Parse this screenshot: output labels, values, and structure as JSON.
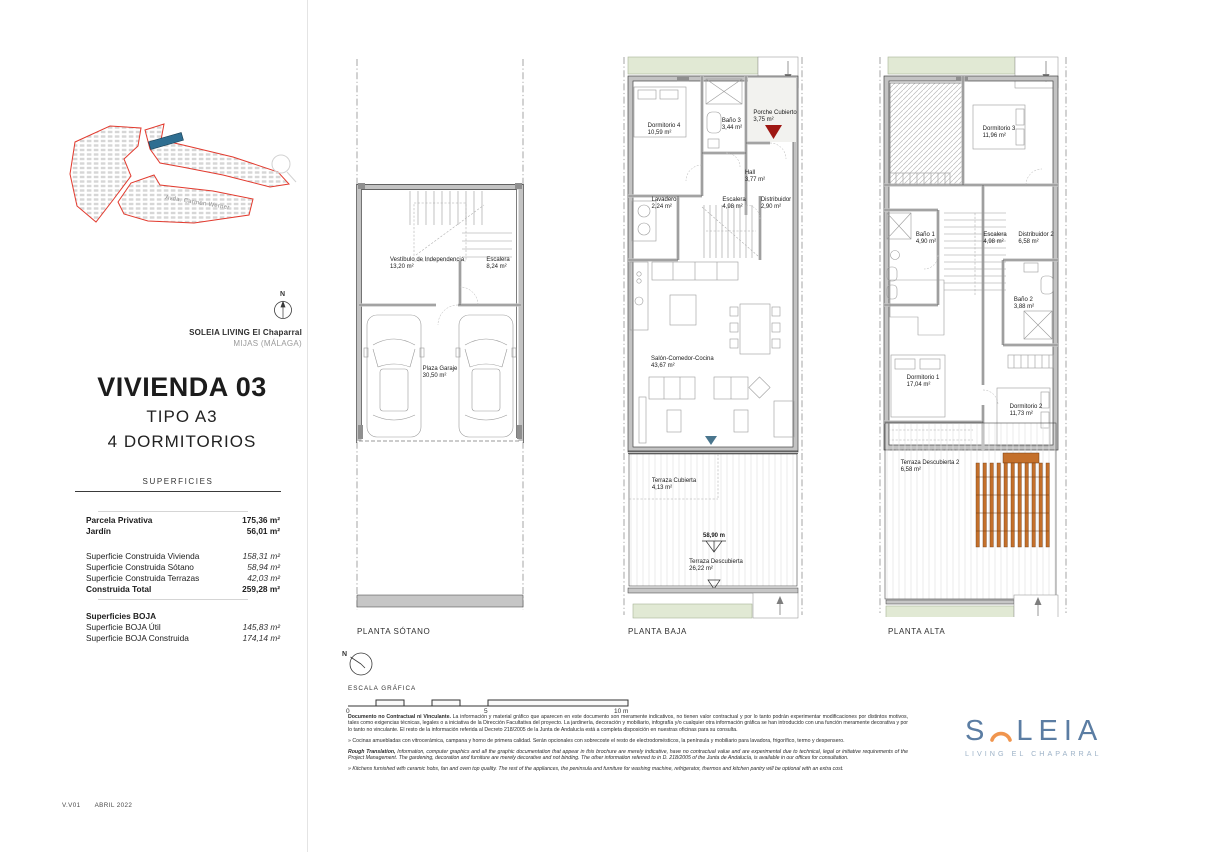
{
  "meta": {
    "version": "V.V01",
    "date": "ABRIL 2022"
  },
  "site": {
    "project_name": "SOLEIA LIVING El Chaparral",
    "location": "MIJAS (MÁLAGA)",
    "street": "Avda. Carmen Werner",
    "north_label": "N"
  },
  "title": {
    "vivienda": "VIVIENDA 03",
    "tipo": "TIPO A3",
    "dormitorios": "4 DORMITORIOS"
  },
  "superficies": {
    "header": "SUPERFICIES",
    "rows": [
      {
        "label": "Parcela Privativa",
        "value": "175,36 m²"
      },
      {
        "label": "Jardín",
        "value": "56,01 m²"
      },
      {
        "label": "Superficie Construida Vivienda",
        "value": "158,31 m²"
      },
      {
        "label": "Superficie Construida Sótano",
        "value": "58,94 m²"
      },
      {
        "label": "Superficie Construida Terrazas",
        "value": "42,03 m²"
      },
      {
        "label": "Construida Total",
        "value": "259,28 m²"
      },
      {
        "label": "Superficies BOJA",
        "value": ""
      },
      {
        "label": "Superficie BOJA Útil",
        "value": "145,83 m²"
      },
      {
        "label": "Superficie BOJA Construida",
        "value": "174,14 m²"
      }
    ]
  },
  "plans": [
    {
      "label": "PLANTA SÓTANO",
      "rooms": [
        {
          "name": "Vestíbulo de Independencia",
          "area": "13,20 m²"
        },
        {
          "name": "Escalera",
          "area": "8,24 m²"
        },
        {
          "name": "Plaza Garaje",
          "area": "30,50 m²"
        }
      ]
    },
    {
      "label": "PLANTA BAJA",
      "elevation": "58,90 m",
      "rooms": [
        {
          "name": "Dormitorio 4",
          "area": "10,59 m²"
        },
        {
          "name": "Baño 3",
          "area": "3,44 m²"
        },
        {
          "name": "Porche Cubierto",
          "area": "3,75 m²"
        },
        {
          "name": "Hall",
          "area": "3,77 m²"
        },
        {
          "name": "Lavadero",
          "area": "2,24 m²"
        },
        {
          "name": "Escalera",
          "area": "4,98 m²"
        },
        {
          "name": "Distribuidor",
          "area": "2,90 m²"
        },
        {
          "name": "Salón-Comedor-Cocina",
          "area": "43,67 m²"
        },
        {
          "name": "Terraza Cubierta",
          "area": "4,13 m²"
        },
        {
          "name": "Terraza Descubierta",
          "area": "26,22 m²"
        }
      ]
    },
    {
      "label": "PLANTA ALTA",
      "rooms": [
        {
          "name": "Dormitorio 3",
          "area": "11,96 m²"
        },
        {
          "name": "Baño 1",
          "area": "4,90 m²"
        },
        {
          "name": "Escalera",
          "area": "4,98 m²"
        },
        {
          "name": "Distribuidor 2",
          "area": "6,58 m²"
        },
        {
          "name": "Baño 2",
          "area": "3,88 m²"
        },
        {
          "name": "Dormitorio 1",
          "area": "17,04 m²"
        },
        {
          "name": "Dormitorio 2",
          "area": "11,73 m²"
        },
        {
          "name": "Terraza Descubierta 2",
          "area": "6,58 m²"
        }
      ]
    }
  ],
  "scale": {
    "label": "ESCALA GRÁFICA",
    "tick0": "0",
    "tick5": "5",
    "tick10": "10 m"
  },
  "disclaimer": {
    "p1_lead": "Documento no Contractual ni Vinculante.",
    "p1_text": " La información y material gráfico que aparecen en este documento son meramente indicativos, no tienen valor contractual y por lo tanto podrán experimentar modificaciones por distintos motivos, tales como exigencias técnicas, legales o a iniciativa de la Dirección Facultativa del proyecto. La jardinería, decoración y mobiliario, infografía y/o cualquier otra información gráfica se han introducido con una función meramente decorativa y por lo tanto no vinculante. El resto de la información referida al Decreto 218/2005 de la Junta de Andalucía está a completa disposición en nuestras oficinas para su consulta.",
    "p2_text": "» Cocinas amuebladas con vitrocerámica, campana y horno de primera calidad. Serán opcionales con sobrecoste el resto de electrodomésticos, la península y mobiliario para lavadora, frigorífico, termo y despensero.",
    "p3_lead": "Rough Translation,",
    "p3_text": " Information, computer graphics and all the graphic documentation that appear in this brochure are merely indicative, have no contractual value and are experimental due to technical, legal or initiative requirements of the Project Management. The gardening, decoration and furniture are merely decorative and not binding. The other information referred to in D. 218/2005 of the Junta de Andalucía, is available in our offices for consultation.",
    "p4_text": "» Kitchens furnished with ceramic hobs, fan and oven top quality. The rest of the appliances, the peninsula and furniture for washing machine, refrigerator, thermos and kitchen pantry will be optional with an extra cost."
  },
  "logo": {
    "s": "S",
    "leia": "LEIA",
    "subtitle": "LIVING EL CHAPARRAL"
  },
  "colors": {
    "entrance_red": "#9e1713",
    "terrace_teal": "#49758d",
    "pergola_orange": "#c4702b",
    "site_outline_red": "#e23a2e",
    "plot_blue": "#2f6e91",
    "logo_blue": "#5b7da3",
    "logo_arc_orange": "#f0954e",
    "garden_green": "#e1e9d4"
  }
}
